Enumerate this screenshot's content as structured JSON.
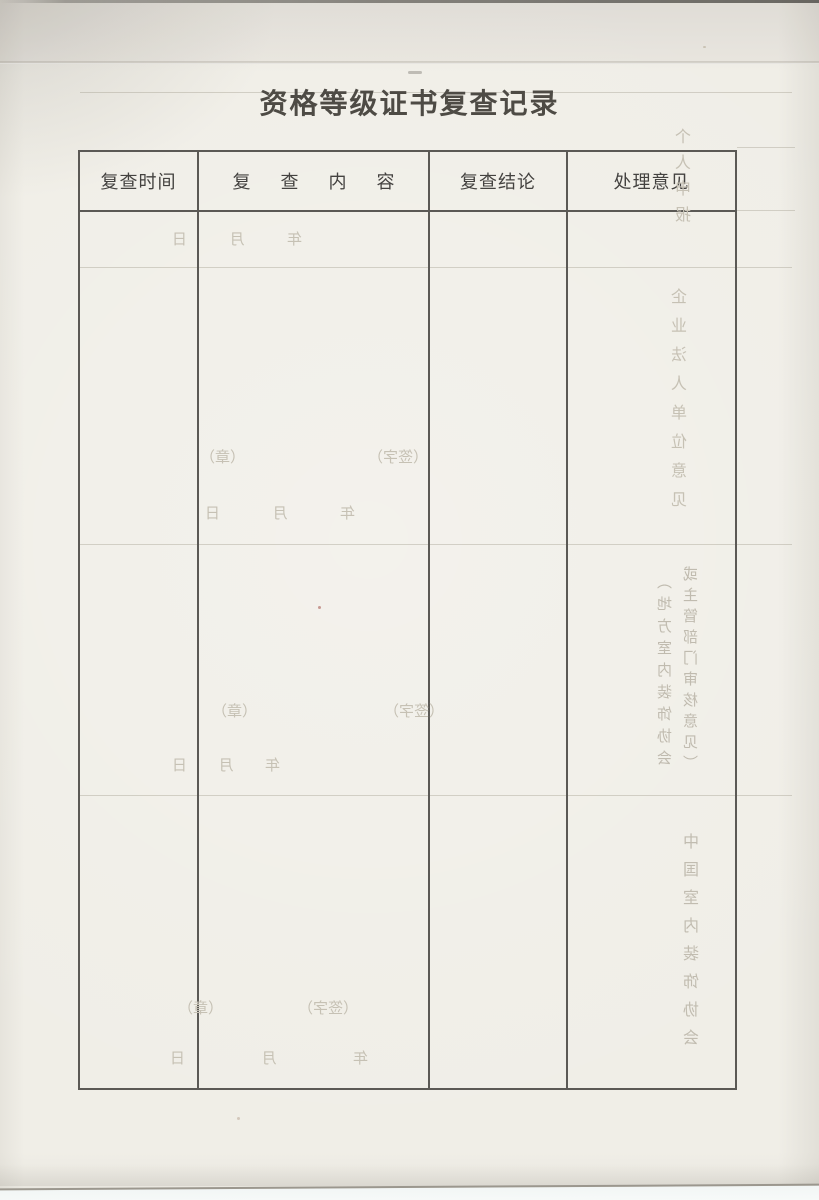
{
  "page": {
    "title": "资格等级证书复查记录"
  },
  "table": {
    "headers": [
      "复查时间",
      "复查内容",
      "复查结论",
      "处理意见"
    ]
  },
  "bleedthrough": {
    "year": "年",
    "month": "月",
    "day": "日",
    "sign_label": "（签字）",
    "seal_label": "（章）",
    "vertical_labels": [
      "个人申报",
      "企业法人单位意见",
      "（地方室内装饰协会",
      "或主管部门审核意见）",
      "中国室内装饰协会"
    ]
  },
  "colors": {
    "paper": "#f0eee7",
    "table_border": "#5b5955",
    "title_text": "#4e4b45",
    "header_text": "#444240",
    "ghost_text": "#c6c1b4"
  }
}
